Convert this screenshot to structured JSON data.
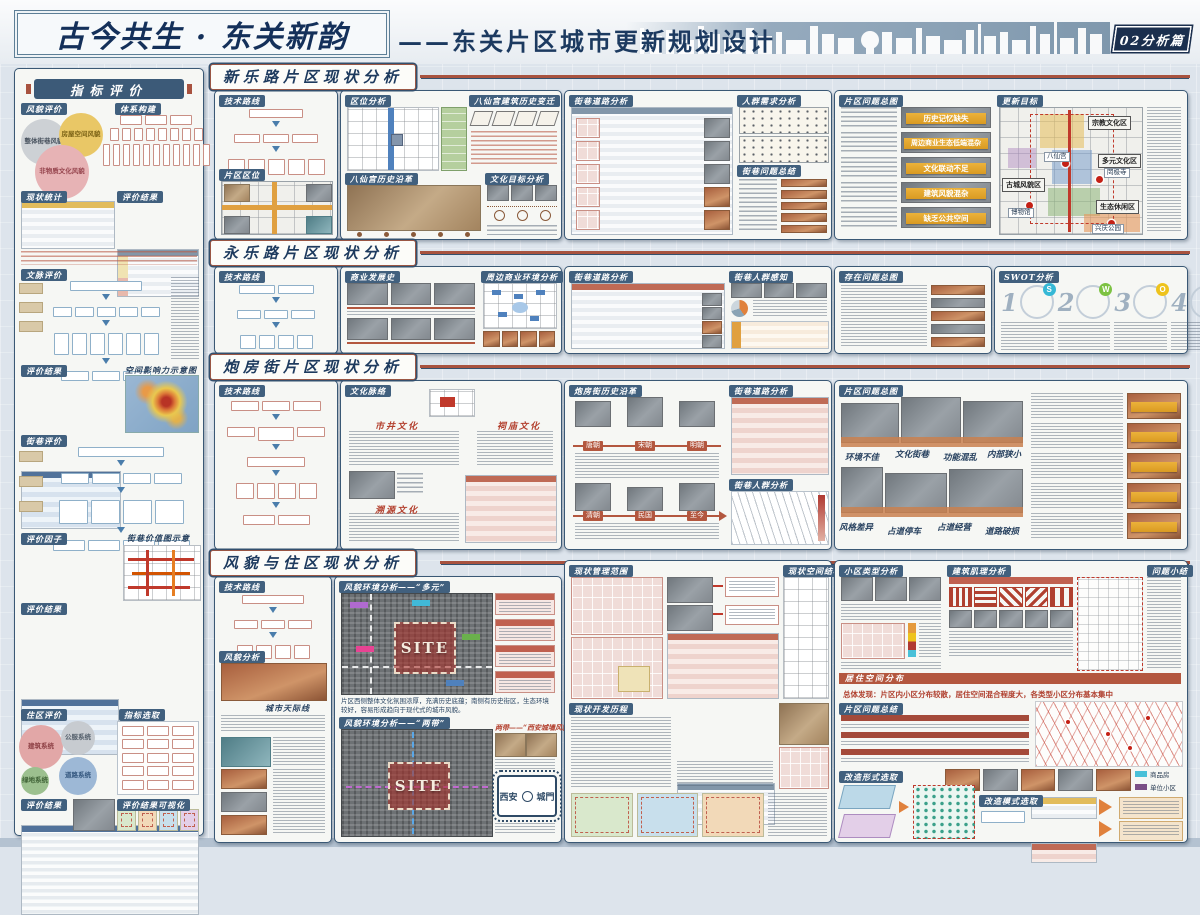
{
  "page": {
    "title": "古今共生 · 东关新韵",
    "subtitle": "——东关片区城市更新规划设计",
    "badge": "02分析篇"
  },
  "sidebar": {
    "header": "指标评价",
    "tag_fengmao": "风貌评价",
    "tag_tixi": "体系构建",
    "tag_xianzhuang": "现状统计",
    "tag_pingjia1": "评价结果",
    "tag_wenmai": "文脉评价",
    "tag_pingjia2": "评价结果",
    "heatmap_title": "空间影响力示意图",
    "tag_jiexiang": "街巷评价",
    "tag_yinzi": "评价因子",
    "map_title": "街巷价值图示意",
    "tag_pingjia3": "评价结果",
    "tag_zhuqu": "住区评价",
    "tag_zhibiao": "指标选取",
    "tag_pingjia4": "评价结果",
    "tag_keshihua": "评价结果可视化",
    "fengmao_circles": [
      "整体街巷风貌",
      "房屋空间风貌",
      "非物质文化风貌"
    ],
    "zhuqu_circles": [
      "建筑系统",
      "公服系统",
      "绿地系统",
      "道路系统"
    ]
  },
  "band1": {
    "header": "新乐路片区现状分析",
    "tag_jishu": "技术路线",
    "tag_quwei": "片区区位",
    "tag_quweifx": "区位分析",
    "tag_bianqian": "八仙宫建筑历史变迁",
    "tag_yange": "八仙宫历史沿革",
    "tag_wenhua": "文化目标分析",
    "tag_daolu": "街巷道路分析",
    "tag_renqun": "人群需求分析",
    "tag_wenti": "街巷问题总结",
    "tag_zongtu": "片区问题总图",
    "tag_mubiao": "更新目标",
    "problems": [
      "历史记忆缺失",
      "周边商业生态低端混杂",
      "文化联动不足",
      "建筑风貌混杂",
      "缺乏公共空间"
    ],
    "zones": [
      "宗教文化区",
      "多元文化区",
      "生态休闲区",
      "古城风貌区"
    ],
    "landmarks": [
      "八仙宫",
      "博物馆",
      "罔极寺",
      "兴庆公园"
    ]
  },
  "band2": {
    "header": "永乐路片区现状分析",
    "tag_jishu": "技术路线",
    "tag_shangye": "商业发展史",
    "tag_zhoubian": "周边商业环境分析",
    "tag_daolu": "街巷道路分析",
    "tag_ganzhi": "街巷人群感知",
    "tag_wenti": "存在问题总图",
    "tag_swot": "SWOT分析",
    "swot": [
      {
        "num": "1",
        "letter": "S"
      },
      {
        "num": "2",
        "letter": "W"
      },
      {
        "num": "3",
        "letter": "O"
      },
      {
        "num": "4",
        "letter": "T"
      }
    ]
  },
  "band3": {
    "header": "炮房街片区现状分析",
    "tag_jishu": "技术路线",
    "tag_wenmai": "文化脉络",
    "tag_yange": "炮房街历史沿革",
    "tag_daolu": "街巷道路分析",
    "tag_renqun": "街巷人群分析",
    "tag_zongtu": "片区问题总图",
    "culture": [
      "市井文化",
      "祠庙文化",
      "溯源文化"
    ],
    "eras": [
      "唐朝",
      "宋朝",
      "明朝",
      "清朝",
      "民国",
      "至今"
    ],
    "photo_labels": [
      "环境不佳",
      "文化街巷",
      "功能混乱",
      "内部狭小",
      "风格差异",
      "占道停车",
      "占道经营",
      "道路破损"
    ]
  },
  "band4": {
    "header": "风貌与住区现状分析",
    "tag_jishu": "技术路线",
    "tag_fengmao": "风貌分析",
    "tag_tianji": "城市天际线",
    "tag_duoyuan": "风貌环境分析——“多元”",
    "tag_liangdai": "风貌环境分析——“两带”",
    "liangdai_note": "两带——“西安城墙风貌带”",
    "tag_guanli": "现状管理范围",
    "tag_jiegou": "现状空间结构",
    "tag_licheng": "现状开发历程",
    "tag_xiaoqu": "小区类型分析",
    "tag_jili": "建筑肌理分析",
    "tag_xiaojie": "问题小结",
    "tag_juzhu": "居住空间分布",
    "tag_zongjie": "片区问题总结",
    "tag_xingshi": "改造形式选取",
    "tag_moshi": "改造模式选取",
    "site": "SITE",
    "finding": "总体发现：片区内小区分布较散，居住空间混合程度大，各类型小区分布基本集中",
    "desc": "片区西侧整体文化氛围浓厚，充满历史底蕴；南侧有历史街区，生态环境较好，容易形成趋向于现代式的城市风貌。",
    "roundel": {
      "left": "西安",
      "right": "城門"
    },
    "legend": [
      "商品房",
      "单位小区",
      "更新小区",
      "老旧房"
    ]
  }
}
